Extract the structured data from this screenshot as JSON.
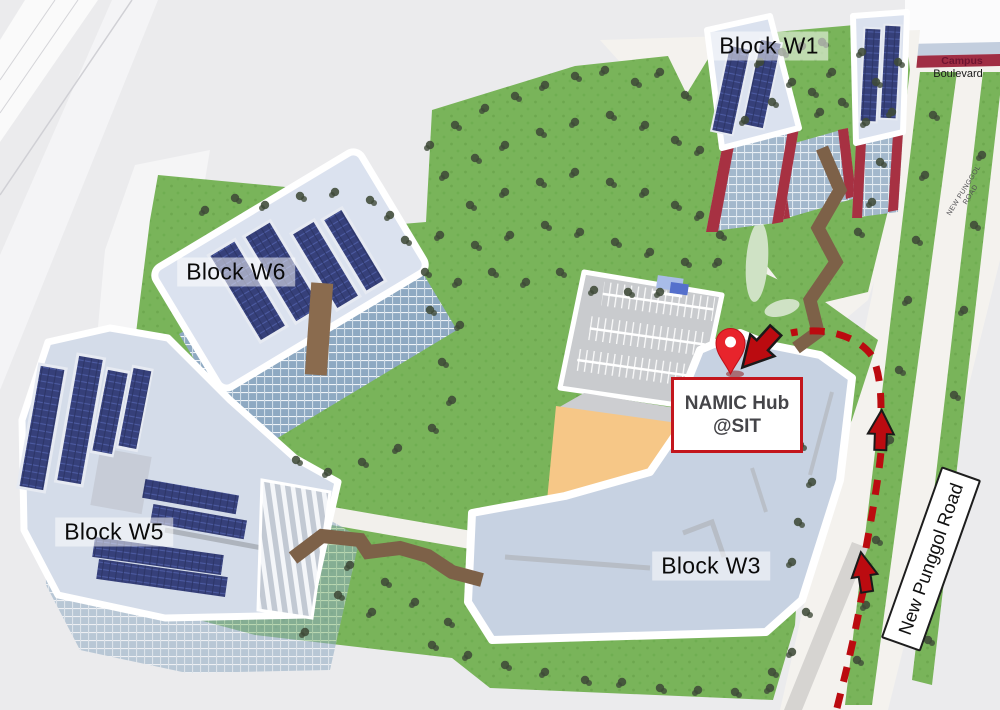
{
  "map": {
    "building_labels": [
      {
        "id": "w1",
        "label": "Block W1"
      },
      {
        "id": "w6",
        "label": "Block W6"
      },
      {
        "id": "w5",
        "label": "Block W5"
      },
      {
        "id": "w3",
        "label": "Block W3"
      }
    ],
    "destination_callout": {
      "line1": "NAMIC Hub",
      "line2": "@SIT"
    },
    "destination_marker": "location-pin",
    "road_sign": {
      "label": "New Punggol Road"
    },
    "road_labels": {
      "campus_line1": "Campus",
      "campus_line2": "Boulevard",
      "new_punggol_line1": "NEW PUNGGOL",
      "new_punggol_line2": "ROAD"
    },
    "colors": {
      "route_red": "#bb0b10",
      "pin_red": "#e8242c",
      "callout_border_red": "#c3161d",
      "callout_text": "#454549",
      "grass_green": "#79b45a",
      "tree_green": "#3f4a38",
      "building_roof": "#dbe2ef",
      "block_w3_fill": "#c7d2e2",
      "solar_panel_blue": "#36407a",
      "glass_facade_blue": "#a3b8cc",
      "walkway_brown": "#7d6148",
      "court_orange": "#f6c787",
      "parking_gray": "#c9cbce",
      "road_white": "#f4f2ee",
      "background_gray": "#ebebed",
      "boulevard_red": "#a02e44",
      "boulevard_band_blue": "#c3cede"
    }
  }
}
